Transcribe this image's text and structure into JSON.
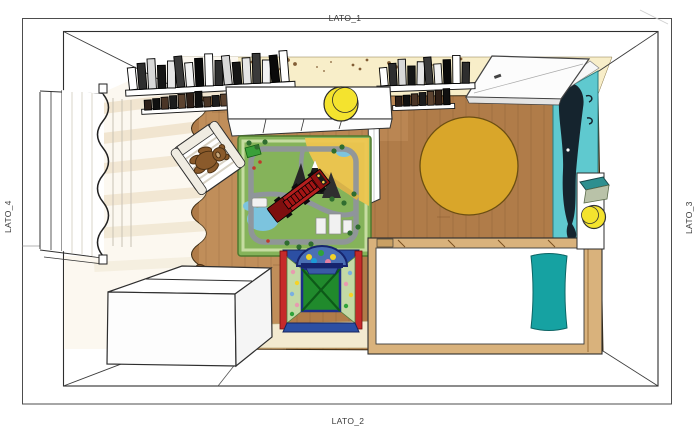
{
  "labels": {
    "top": "LATO_1",
    "bottom": "LATO_2",
    "left": "LATO_4",
    "right": "LATO_3"
  },
  "colors": {
    "wood": "#b07c49",
    "wood_light": "#cf9f6b",
    "wall_cream": "#f8eec9",
    "floor_beige": "#f3ead0",
    "wall_teal": "#5fc9cf",
    "whale": "#15242e",
    "rug_yellow": "#d9a62a",
    "mat_green": "#85b35a",
    "road_gray": "#8f959b",
    "sand_yellow": "#eec54f",
    "water_blue": "#7cc4de",
    "truck_red": "#b51f1f",
    "tent_blue": "#2c4fa3",
    "tent_green": "#208a2c",
    "tent_red": "#c62a2a",
    "tent_dots_bg": "#c3d9a5",
    "pillow_teal": "#16a2a2",
    "bed_wood": "#d9b27c",
    "pouf_yellow": "#f4e32e",
    "bear_brown": "#8a5a2b",
    "shelf_teal": "#2e8f8f"
  },
  "decor": {
    "bookshelves": [
      {
        "x": 128,
        "y": 60,
        "count": 17,
        "bar_w": 9.5,
        "row1_h": 30,
        "tilt": -3
      },
      {
        "x": 380,
        "y": 60,
        "count": 10,
        "bar_w": 9.0,
        "row1_h": 26,
        "tilt": -2
      }
    ],
    "speckle_count": 24,
    "plank_spacing": 13,
    "joint_count": 16
  },
  "objects": [
    "window-with-curtain",
    "bookshelf-1",
    "bookshelf-2",
    "storage-bench",
    "pouf",
    "door-open-leaf",
    "teal-wall",
    "whale-decal",
    "round-rug",
    "play-mat",
    "toy-fire-truck",
    "armchair",
    "teddy-bear-on-chair",
    "teddy-bear-on-floor",
    "play-tent",
    "ball-pit-opening",
    "storage-chest",
    "bed",
    "bed-pillow",
    "headboard-panel",
    "wall-shelf",
    "ball-lamp"
  ]
}
